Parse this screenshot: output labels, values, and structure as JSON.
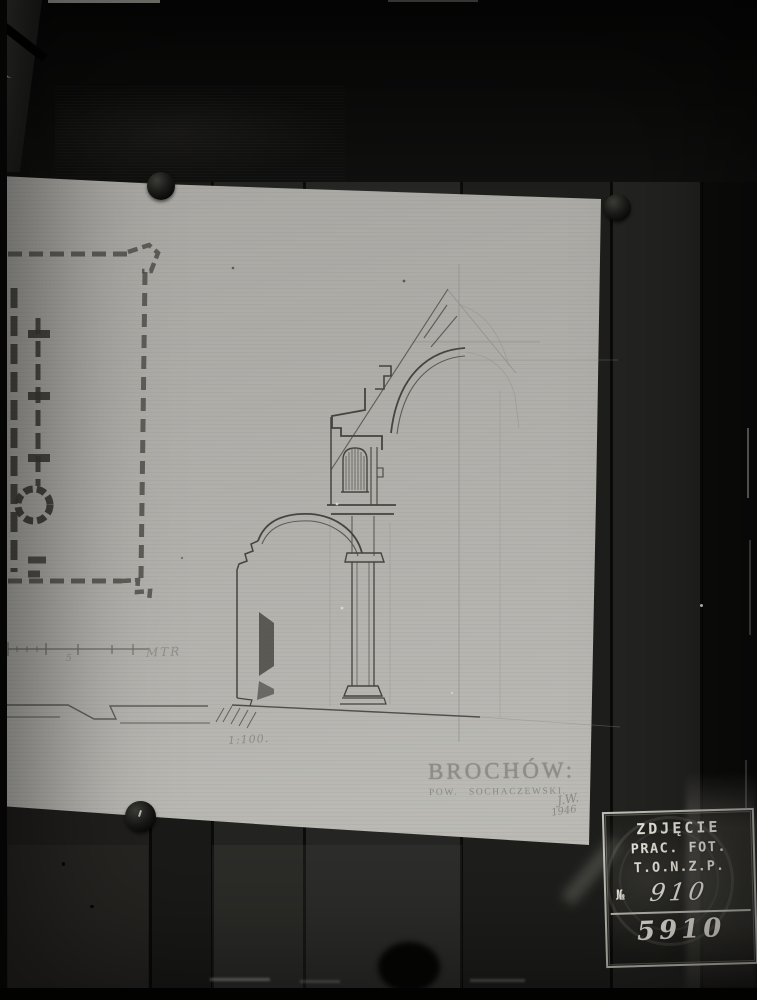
{
  "paper": {
    "title": "BROCHÓW:",
    "subtitle": "POW. SOCHACZEWSKI.",
    "scale_note": "1:100.",
    "scale_bar_label": "MTR",
    "scale_bar_number": "5",
    "signature_line1": "J.W.",
    "signature_line2": "1946"
  },
  "stamp": {
    "line1": "ZDJĘCIE",
    "line2": "PRAC. FOT.",
    "line3": "T.O.N.Z.P.",
    "number_label": "№",
    "number_value": "910",
    "catalog_number": "5910"
  },
  "colors": {
    "paper": "#b2b1ac",
    "pencil_dark": "#45443f",
    "pencil_faint": "#8a8984",
    "wood_dark": "#141412",
    "stamp_ink": "#e8e6dc"
  }
}
